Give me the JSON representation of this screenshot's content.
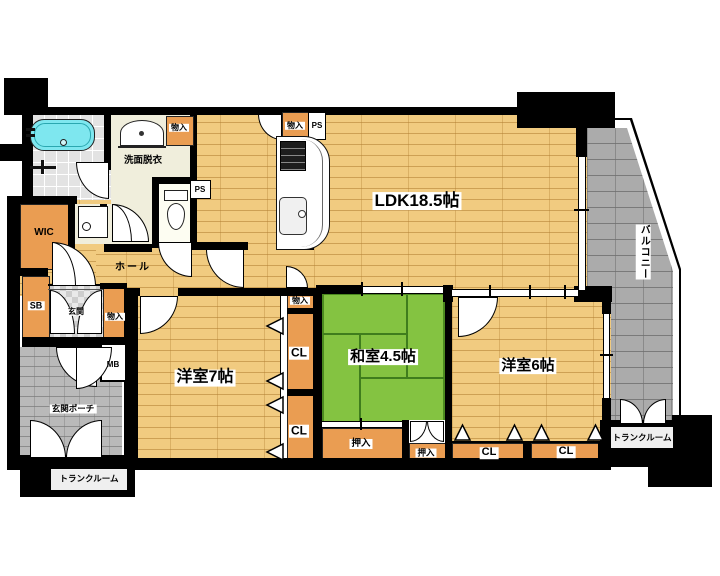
{
  "document": {
    "kind": "apartment-floorplan"
  },
  "labels": {
    "ldk": "LDK18.5帖",
    "washitsu": "和室4.5帖",
    "yoshitsu7": "洋室7帖",
    "yoshitsu6": "洋室6帖",
    "balcony": "バルコニー",
    "hall": "ホール",
    "senmen_datsui": "洗面脱衣",
    "genkan": "玄関",
    "genkan_porch": "玄関ポーチ",
    "wic": "WIC",
    "sb": "SB",
    "mb": "MB",
    "trunk_room": "トランクルーム",
    "monoiri": "物入",
    "ps": "PS",
    "cl": "CL",
    "oshiire": "押入"
  },
  "colors": {
    "wall": "#000000",
    "wood": "#F1CB80",
    "tatami": "#84C341",
    "closet": "#EA9D52",
    "balcony": "#ABABAB",
    "porch": "#B9B9B9",
    "tub": "#7EE7EF",
    "washfloor": "#F0EEDC"
  }
}
